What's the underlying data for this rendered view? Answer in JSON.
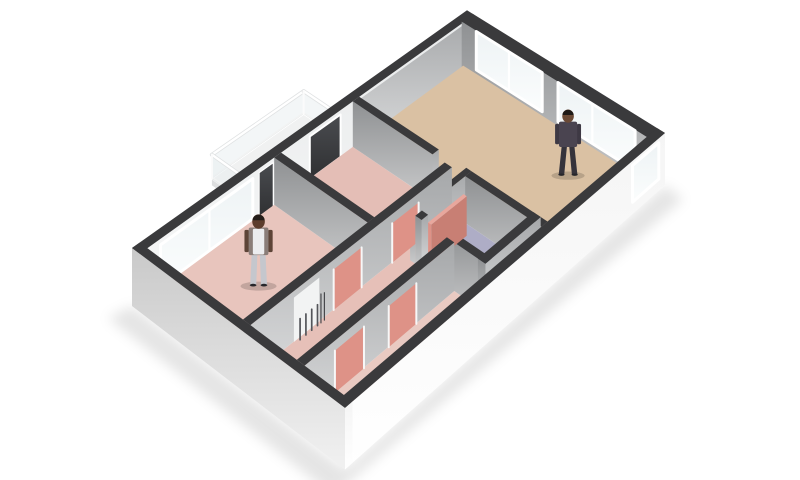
{
  "meta": {
    "label": "3D isometric floor plan rendering of an apartment",
    "canvas": {
      "width": 800,
      "height": 480
    },
    "background": "#ffffff"
  },
  "projection": {
    "corners": {
      "W": [
        132,
        298
      ],
      "N": [
        467,
        53
      ],
      "E": [
        665,
        178
      ],
      "S": [
        345,
        461
      ]
    },
    "wall_px": 50,
    "slab_z": -0.16
  },
  "palette": {
    "wallTop": "#3a3a3c",
    "door": "#de9287",
    "doorTop": "#e8a79d",
    "doorSide": "#c87f74",
    "floorBedroom": "#e8c5bd",
    "floorStudy": "#e4beb6",
    "floorHall": "#e6c0b8",
    "floorCloset": "#e9cac2",
    "floorBath": "#aeadc6",
    "floorEntry": "#b4b4b6",
    "floorLiving": "#dac1a3",
    "balconyTop": "#f0f1f1",
    "balconyLeft": "#dddedf",
    "balconyRight": "#e9eaea",
    "counterTop": "#f3f3f3",
    "counterLeft": "#fdfdfd",
    "counterRight": "#e9e9e9",
    "nichePanel": "#f2f3f3",
    "radiatorDark": "#54555a",
    "shadow": "rgba(0,0,0,0.10)"
  },
  "rooms": [
    {
      "id": "living-room",
      "floor_color": "#dac1a3",
      "occupant": "person-living-room",
      "features": [
        "two large windows",
        "side window",
        "kitchen counter"
      ]
    },
    {
      "id": "bedroom",
      "floor_color": "#e8c5bd",
      "occupant": "person-bedroom",
      "features": [
        "large window",
        "radiator niche"
      ]
    },
    {
      "id": "study",
      "floor_color": "#e4beb6",
      "features": [
        "dark glass balcony door"
      ]
    },
    {
      "id": "hallway",
      "floor_color": "#e6c0b8",
      "features": [
        "salmon interior doors"
      ]
    },
    {
      "id": "closet",
      "floor_color": "#e9cac2",
      "features": [
        "two salmon doors"
      ]
    },
    {
      "id": "bathroom",
      "floor_color": "#aeadc6",
      "features": [
        "open salmon door"
      ]
    },
    {
      "id": "balcony",
      "floor_color": "#f0f1f1",
      "features": [
        "glass railing"
      ]
    }
  ],
  "people": [
    {
      "id": "person-living-room",
      "variant": "plaid",
      "skin": "#6b4a36",
      "hair": "#1f1a17",
      "shirt": "#4a4450",
      "pants": "#35333b",
      "arm": "#3e3944"
    },
    {
      "id": "person-bedroom",
      "variant": "vest",
      "skin": "#5d3c2c",
      "hair": "#241d19",
      "shirt": "#8a7d78",
      "pants": "#c5c7cd",
      "arm": "#5d4437"
    }
  ],
  "elements": [
    {
      "t": "shadow",
      "name": "ground-shadow"
    },
    {
      "t": "box",
      "name": "balcony-slab",
      "u1": 0.325,
      "v1": -0.21,
      "u2": 0.595,
      "v2": 0.005,
      "z0": -0.1,
      "z1": 0.02,
      "top": "balconyTop",
      "left": "balconyLeft",
      "right": "balconyRight"
    },
    {
      "t": "rail",
      "name": "balcony-railing-outer",
      "a": [
        0.325,
        -0.21
      ],
      "b": [
        0.595,
        -0.21
      ]
    },
    {
      "t": "rail",
      "name": "balcony-railing-right",
      "a": [
        0.595,
        -0.21
      ],
      "b": [
        0.595,
        -0.005
      ]
    },
    {
      "t": "rail",
      "name": "balcony-railing-left",
      "a": [
        0.325,
        -0.21
      ],
      "b": [
        0.325,
        -0.005
      ]
    },
    {
      "t": "box",
      "name": "outer-wall-north",
      "u1": 0,
      "v1": 0,
      "u2": 1,
      "v2": 0.038,
      "z0": -0.16,
      "z1": 1,
      "top": "wallTop",
      "left": "outL",
      "right": "innerLight"
    },
    {
      "t": "pane",
      "name": "living-north-wall-face",
      "a": [
        0.62,
        0.0455
      ],
      "b": [
        0.999,
        0.0455
      ],
      "z0": -0.02,
      "z1": 0.985,
      "fill": "grayR"
    },
    {
      "t": "pane",
      "name": "bedroom-window",
      "a": [
        0.05,
        0.045
      ],
      "b": [
        0.3,
        0.045
      ],
      "z0": 0.08,
      "z1": 0.92,
      "fill": "glass",
      "frame": 3,
      "mullions": [
        0.52
      ]
    },
    {
      "t": "pane",
      "name": "balcony-side-glass",
      "a": [
        0.318,
        0.0452
      ],
      "b": [
        0.358,
        0.0452
      ],
      "z0": 0.02,
      "z1": 0.95,
      "fill": "darkGlass",
      "frame": 1
    },
    {
      "t": "pane",
      "name": "balcony-door-glass",
      "a": [
        0.465,
        0.0452
      ],
      "b": [
        0.558,
        0.0452
      ],
      "z0": 0.02,
      "z1": 0.95,
      "fill": "darkGlass",
      "frame": 2
    },
    {
      "t": "box",
      "name": "outer-wall-east",
      "u1": 0.962,
      "v1": 0.03,
      "u2": 1,
      "v2": 1,
      "z0": -0.16,
      "z1": 1,
      "top": "wallTop",
      "left": "grayL",
      "right": "outR"
    },
    {
      "t": "pane",
      "name": "living-window-north",
      "a": [
        0.9665,
        0.1
      ],
      "b": [
        0.9665,
        0.44
      ],
      "z0": 0.05,
      "z1": 0.94,
      "fill": "glass",
      "frame": 3,
      "mullions": [
        0.5
      ]
    },
    {
      "t": "pane",
      "name": "living-window-east",
      "a": [
        0.9665,
        0.52
      ],
      "b": [
        0.9665,
        0.9
      ],
      "z0": 0.05,
      "z1": 0.94,
      "fill": "glass",
      "frame": 3,
      "mullions": [
        0.45
      ]
    },
    {
      "t": "floor",
      "name": "bedroom-floor",
      "pts": [
        [
          0.02,
          0.038
        ],
        [
          0.365,
          0.038
        ],
        [
          0.365,
          0.5
        ],
        [
          0.02,
          0.5
        ]
      ],
      "fill": "floorBedroom"
    },
    {
      "t": "floor",
      "name": "study-floor",
      "pts": [
        [
          0.385,
          0.038
        ],
        [
          0.6,
          0.038
        ],
        [
          0.6,
          0.5
        ],
        [
          0.385,
          0.5
        ]
      ],
      "fill": "floorStudy"
    },
    {
      "t": "floor",
      "name": "hallway-floor",
      "pts": [
        [
          0.02,
          0.535
        ],
        [
          0.6,
          0.535
        ],
        [
          0.6,
          0.6
        ],
        [
          0.445,
          0.6
        ],
        [
          0.445,
          0.75
        ],
        [
          0.02,
          0.75
        ]
      ],
      "fill": "floorHall"
    },
    {
      "t": "floor",
      "name": "closet-floor",
      "pts": [
        [
          0.02,
          0.785
        ],
        [
          0.445,
          0.785
        ],
        [
          0.445,
          0.962
        ],
        [
          0.02,
          0.962
        ]
      ],
      "fill": "floorCloset"
    },
    {
      "t": "floor",
      "name": "bathroom-floor",
      "pts": [
        [
          0.465,
          0.6
        ],
        [
          0.6,
          0.6
        ],
        [
          0.6,
          0.895
        ],
        [
          0.465,
          0.895
        ]
      ],
      "fill": "floorBath"
    },
    {
      "t": "floor",
      "name": "entry-floor",
      "pts": [
        [
          0.465,
          0.93
        ],
        [
          0.6,
          0.93
        ],
        [
          0.6,
          0.962
        ],
        [
          0.465,
          0.962
        ]
      ],
      "fill": "floorEntry"
    },
    {
      "t": "floor",
      "name": "living-room-floor",
      "pts": [
        [
          0.62,
          0.038
        ],
        [
          0.962,
          0.038
        ],
        [
          0.962,
          0.962
        ],
        [
          0.62,
          0.962
        ]
      ],
      "fill": "floorLiving"
    },
    {
      "t": "floor",
      "name": "passage-floor",
      "pts": [
        [
          0.6,
          0.44
        ],
        [
          0.62,
          0.44
        ],
        [
          0.62,
          0.575
        ],
        [
          0.6,
          0.575
        ]
      ],
      "fill": "floorLiving"
    },
    {
      "t": "person",
      "name": "person-bedroom",
      "u": 0.19,
      "v": 0.27,
      "person": 1
    },
    {
      "t": "person",
      "name": "person-living-room",
      "u": 0.86,
      "v": 0.72,
      "person": 0
    },
    {
      "t": "box",
      "name": "wall-study-living",
      "u1": 0.6,
      "v1": 0.038,
      "u2": 0.62,
      "v2": 0.44,
      "top": "wallTop",
      "left": "grayL",
      "right": "grayR"
    },
    {
      "t": "box",
      "name": "wall-bathroom-north",
      "u1": 0.445,
      "v1": 0.575,
      "u2": 0.62,
      "v2": 0.6,
      "top": "wallTop",
      "left": "grayL",
      "right": "grayR"
    },
    {
      "t": "box",
      "name": "wall-bathroom-east",
      "u1": 0.6,
      "v1": 0.6,
      "u2": 0.62,
      "v2": 0.962,
      "top": "wallTop",
      "left": "grayL",
      "right": "grayR"
    },
    {
      "t": "box",
      "name": "wall-bedroom-study",
      "u1": 0.365,
      "v1": 0.038,
      "u2": 0.385,
      "v2": 0.5,
      "top": "wallTop",
      "left": "grayL",
      "right": "grayR"
    },
    {
      "t": "box",
      "name": "wall-hallway-north",
      "u1": 0.02,
      "v1": 0.5,
      "u2": 0.6,
      "v2": 0.535,
      "top": "wallTop",
      "left": "grayL",
      "right": "grayR"
    },
    {
      "t": "pane",
      "name": "radiator-niche-panel",
      "a": [
        0.135,
        0.5365
      ],
      "b": [
        0.205,
        0.5365
      ],
      "z0": 0,
      "z1": 0.88,
      "fill": "nichePanel"
    },
    {
      "t": "radiator",
      "name": "radiator",
      "u0": 0.147,
      "du": 0.016,
      "n": 4,
      "v": 0.545
    },
    {
      "t": "pane",
      "name": "door-bedroom",
      "a": [
        0.245,
        0.537
      ],
      "b": [
        0.325,
        0.537
      ],
      "z0": 0,
      "z1": 0.82,
      "fill": "door",
      "jamb": true
    },
    {
      "t": "pane",
      "name": "door-study",
      "a": [
        0.415,
        0.537
      ],
      "b": [
        0.495,
        0.537
      ],
      "z0": 0,
      "z1": 0.82,
      "fill": "door",
      "jamb": true
    },
    {
      "t": "box",
      "name": "wall-bathroom-west-a",
      "u1": 0.445,
      "v1": 0.6,
      "u2": 0.465,
      "v2": 0.63,
      "top": "wallTop",
      "left": "grayL",
      "right": "grayR"
    },
    {
      "t": "box",
      "name": "wall-bathroom-west-b",
      "u1": 0.445,
      "v1": 0.72,
      "u2": 0.465,
      "v2": 0.962,
      "top": "wallTop",
      "left": "grayL",
      "right": "grayR"
    },
    {
      "t": "box",
      "name": "bathroom-door-open",
      "u1": 0.465,
      "v1": 0.63,
      "u2": 0.575,
      "v2": 0.645,
      "z0": 0,
      "z1": 0.84,
      "top": "doorTop",
      "left": "door",
      "right": "doorSide"
    },
    {
      "t": "box",
      "name": "wall-bathroom-south",
      "u1": 0.445,
      "v1": 0.895,
      "u2": 0.62,
      "v2": 0.93,
      "top": "wallTop",
      "left": "grayL",
      "right": "grayR"
    },
    {
      "t": "box",
      "name": "kitchen-counter",
      "u1": 0.8,
      "v1": 0.89,
      "u2": 0.955,
      "v2": 0.96,
      "z0": 0,
      "z1": 0.5,
      "top": "counterTop",
      "left": "counterLeft",
      "right": "counterRight"
    },
    {
      "t": "box",
      "name": "kitchen-counter-step",
      "u1": 0.775,
      "v1": 0.9,
      "u2": 0.8,
      "v2": 0.955,
      "z0": 0,
      "z1": 0.3,
      "top": "counterTop",
      "left": "counterLeft",
      "right": "counterRight"
    },
    {
      "t": "box",
      "name": "wall-closet-north",
      "u1": 0.02,
      "v1": 0.75,
      "u2": 0.445,
      "v2": 0.785,
      "top": "wallTop",
      "left": "grayL",
      "right": "grayR"
    },
    {
      "t": "pane",
      "name": "door-closet-1",
      "a": [
        0.1,
        0.787
      ],
      "b": [
        0.18,
        0.787
      ],
      "z0": 0,
      "z1": 0.82,
      "fill": "door",
      "jamb": true
    },
    {
      "t": "pane",
      "name": "door-closet-2",
      "a": [
        0.25,
        0.787
      ],
      "b": [
        0.33,
        0.787
      ],
      "z0": 0,
      "z1": 0.82,
      "fill": "door",
      "jamb": true
    },
    {
      "t": "box",
      "name": "outer-wall-south",
      "u1": 0,
      "v1": 0.962,
      "u2": 1,
      "v2": 1,
      "z0": -0.16,
      "z1": 1,
      "top": "wallTop",
      "left": "outL",
      "right": "outR"
    },
    {
      "t": "pane",
      "name": "entry-window",
      "a": [
        0.88,
        1.003
      ],
      "b": [
        0.975,
        1.003
      ],
      "z0": 0.12,
      "z1": 0.92,
      "fill": "glass",
      "frame": 3
    },
    {
      "t": "box",
      "name": "outer-wall-west",
      "u1": 0,
      "v1": 0,
      "u2": 0.02,
      "v2": 1,
      "z0": -0.16,
      "z1": 1,
      "top": "wallTop",
      "left": "outL",
      "right": "outR"
    }
  ]
}
